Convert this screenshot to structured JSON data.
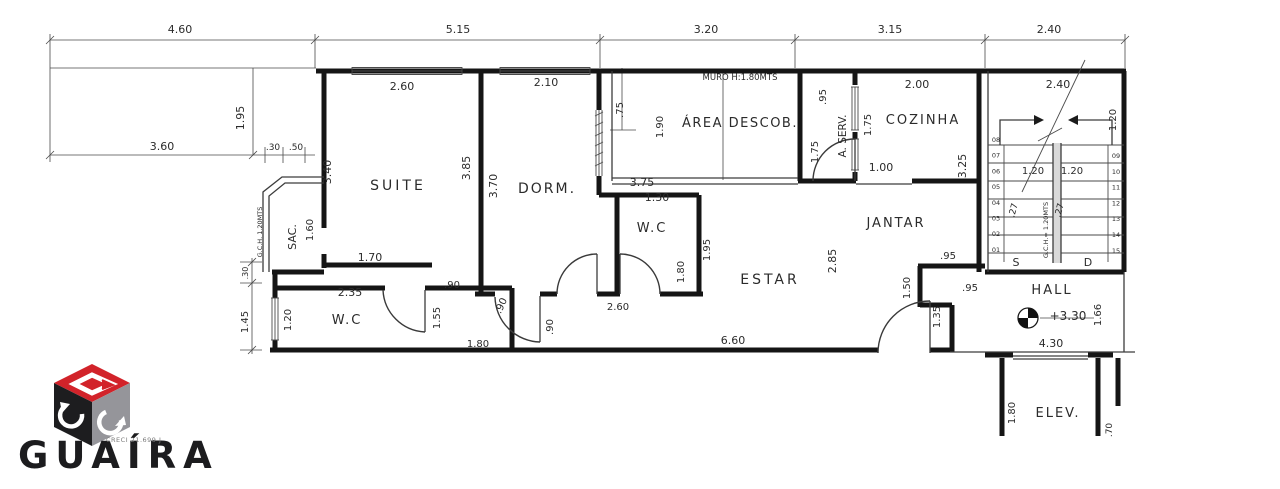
{
  "drawing": {
    "top_dimensions": [
      "4.60",
      "5.15",
      "3.20",
      "3.15",
      "2.40"
    ],
    "labels": [
      {
        "t": "4.60",
        "x": 180,
        "y": 33,
        "n": "dim-top-1"
      },
      {
        "t": "5.15",
        "x": 458,
        "y": 33,
        "n": "dim-top-2"
      },
      {
        "t": "3.20",
        "x": 706,
        "y": 33,
        "n": "dim-top-3"
      },
      {
        "t": "3.15",
        "x": 890,
        "y": 33,
        "n": "dim-top-4"
      },
      {
        "t": "2.40",
        "x": 1049,
        "y": 33,
        "n": "dim-top-5"
      },
      {
        "t": "1.95",
        "x": 244,
        "y": 118,
        "r": -90
      },
      {
        "t": "3.60",
        "x": 162,
        "y": 150
      },
      {
        "t": ".30",
        "x": 273,
        "y": 150,
        "s": 9
      },
      {
        "t": ".50",
        "x": 296,
        "y": 150,
        "s": 9
      },
      {
        "t": "2.60",
        "x": 402,
        "y": 90
      },
      {
        "t": "SUITE",
        "x": 398,
        "y": 190,
        "s": 14,
        "ls": 3,
        "n": "room-label-suite"
      },
      {
        "t": "3.40",
        "x": 331,
        "y": 172,
        "r": -90
      },
      {
        "t": "SAC.",
        "x": 296,
        "y": 237,
        "r": -90,
        "s": 11,
        "n": "room-label-sacada"
      },
      {
        "t": "1.60",
        "x": 313,
        "y": 230,
        "r": -90,
        "s": 10
      },
      {
        "t": "G.C.H. 1.20MTS",
        "x": 262,
        "y": 232,
        "r": -90,
        "s": 6.5
      },
      {
        "t": "1.70",
        "x": 370,
        "y": 261
      },
      {
        "t": ".90",
        "x": 452,
        "y": 288,
        "s": 10
      },
      {
        "t": "2.35",
        "x": 350,
        "y": 296
      },
      {
        "t": "W.C",
        "x": 347,
        "y": 324,
        "s": 13,
        "ls": 2,
        "n": "room-label-wc-suite"
      },
      {
        "t": "1.20",
        "x": 291,
        "y": 320,
        "r": -90,
        "s": 10
      },
      {
        "t": ".30",
        "x": 248,
        "y": 273,
        "r": -90,
        "s": 8
      },
      {
        "t": "1.45",
        "x": 248,
        "y": 322,
        "r": -90,
        "s": 10
      },
      {
        "t": "1.55",
        "x": 440,
        "y": 318,
        "r": -90,
        "s": 10
      },
      {
        "t": ".90",
        "x": 504,
        "y": 307,
        "r": -65,
        "s": 10
      },
      {
        "t": "1.80",
        "x": 478,
        "y": 347,
        "s": 10
      },
      {
        "t": ".90",
        "x": 553,
        "y": 327,
        "r": -90,
        "s": 10
      },
      {
        "t": "2.10",
        "x": 546,
        "y": 86
      },
      {
        "t": "3.85",
        "x": 470,
        "y": 168,
        "r": -90
      },
      {
        "t": "3.70",
        "x": 497,
        "y": 186,
        "r": -90
      },
      {
        "t": "DORM.",
        "x": 547,
        "y": 193,
        "s": 14,
        "ls": 2,
        "n": "room-label-dorm"
      },
      {
        "t": "2.60",
        "x": 618,
        "y": 310,
        "s": 10
      },
      {
        "t": ".75",
        "x": 623,
        "y": 110,
        "r": -90,
        "s": 10
      },
      {
        "t": "1.90",
        "x": 663,
        "y": 127,
        "r": -90,
        "s": 10
      },
      {
        "t": "1.30",
        "x": 657,
        "y": 201
      },
      {
        "t": "W.C",
        "x": 652,
        "y": 232,
        "s": 13,
        "ls": 2,
        "n": "room-label-wc-social"
      },
      {
        "t": "1.95",
        "x": 710,
        "y": 250,
        "r": -90,
        "s": 10
      },
      {
        "t": "1.80",
        "x": 684,
        "y": 272,
        "r": -90,
        "s": 10
      },
      {
        "t": "MURO H:1.80MTS",
        "x": 740,
        "y": 80,
        "s": 8.5
      },
      {
        "t": "ÁREA DESCOB.",
        "x": 740,
        "y": 127,
        "s": 13,
        "ls": 1.5,
        "n": "room-label-area-descoberta"
      },
      {
        "t": "3.75",
        "x": 642,
        "y": 186
      },
      {
        "t": ".95",
        "x": 826,
        "y": 97,
        "r": -90,
        "s": 10
      },
      {
        "t": "A. SERV.",
        "x": 846,
        "y": 136,
        "r": -90,
        "s": 10.5,
        "n": "room-label-area-servico"
      },
      {
        "t": "1.75",
        "x": 818,
        "y": 152,
        "r": -90,
        "s": 10
      },
      {
        "t": "1.75",
        "x": 871,
        "y": 125,
        "r": -90,
        "s": 10
      },
      {
        "t": "2.00",
        "x": 917,
        "y": 88
      },
      {
        "t": "COZINHA",
        "x": 923,
        "y": 124,
        "s": 13,
        "ls": 2,
        "n": "room-label-cozinha"
      },
      {
        "t": "1.00",
        "x": 881,
        "y": 171
      },
      {
        "t": "3.25",
        "x": 966,
        "y": 166,
        "r": -90
      },
      {
        "t": "JANTAR",
        "x": 896,
        "y": 227,
        "s": 13,
        "ls": 2,
        "n": "room-label-jantar"
      },
      {
        "t": "ESTAR",
        "x": 770,
        "y": 284,
        "s": 14,
        "ls": 3,
        "n": "room-label-estar"
      },
      {
        "t": "2.85",
        "x": 836,
        "y": 261,
        "r": -90
      },
      {
        "t": ".95",
        "x": 948,
        "y": 259,
        "s": 10
      },
      {
        "t": "1.50",
        "x": 910,
        "y": 288,
        "r": -90,
        "s": 10
      },
      {
        "t": ".95",
        "x": 970,
        "y": 291,
        "s": 10
      },
      {
        "t": "1.35",
        "x": 940,
        "y": 317,
        "r": -90,
        "s": 10
      },
      {
        "t": "6.60",
        "x": 733,
        "y": 344
      },
      {
        "t": "2.40",
        "x": 1058,
        "y": 88
      },
      {
        "t": "1.20",
        "x": 1116,
        "y": 120,
        "r": -90,
        "s": 10
      },
      {
        "t": "1.20",
        "x": 1033,
        "y": 174,
        "s": 10
      },
      {
        "t": "1.20",
        "x": 1072,
        "y": 174,
        "s": 10
      },
      {
        "t": ".27",
        "x": 1016,
        "y": 211,
        "r": -75,
        "s": 9
      },
      {
        "t": ".27",
        "x": 1062,
        "y": 211,
        "r": -75,
        "s": 9
      },
      {
        "t": "G.C.H.= 1.20MTS",
        "x": 1048,
        "y": 230,
        "r": -90,
        "s": 6.5
      },
      {
        "t": "S",
        "x": 1016,
        "y": 266,
        "s": 11
      },
      {
        "t": "D",
        "x": 1088,
        "y": 266,
        "s": 11
      },
      {
        "t": "HALL",
        "x": 1052,
        "y": 294,
        "s": 13,
        "ls": 2,
        "n": "room-label-hall"
      },
      {
        "t": "+3.30",
        "x": 1068,
        "y": 320,
        "s": 12,
        "n": "level-marker-value"
      },
      {
        "t": "1.66",
        "x": 1101,
        "y": 315,
        "r": -90,
        "s": 10
      },
      {
        "t": "4.30",
        "x": 1051,
        "y": 347
      },
      {
        "t": "ELEV.",
        "x": 1058,
        "y": 417,
        "s": 13,
        "ls": 2,
        "n": "room-label-elevador"
      },
      {
        "t": "1.80",
        "x": 1015,
        "y": 413,
        "r": -90,
        "s": 10
      },
      {
        "t": ".70",
        "x": 1112,
        "y": 430,
        "r": -90,
        "s": 9
      }
    ],
    "stairs": {
      "left_steps": [
        "08",
        "07",
        "06",
        "05",
        "04",
        "03",
        "02",
        "01"
      ],
      "right_steps": [
        "09",
        "10",
        "11",
        "12",
        "13",
        "14",
        "15"
      ],
      "up_letter": "S",
      "down_letter": "D"
    }
  },
  "logo": {
    "name": "GUAÍRA",
    "creci": "CRECI 21.699 J",
    "colors": {
      "red": "#d2232a",
      "black": "#1d1d1f",
      "gray": "#95959a"
    }
  }
}
